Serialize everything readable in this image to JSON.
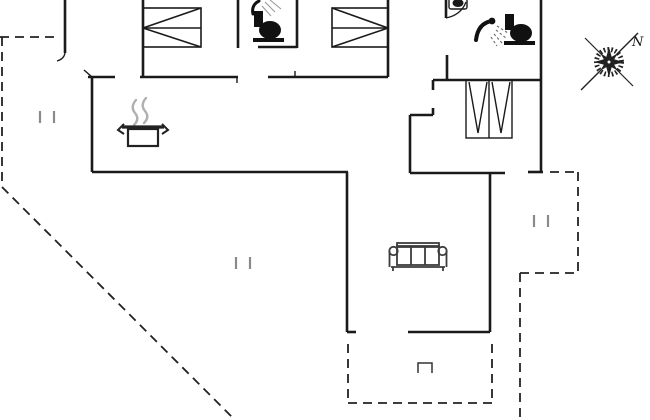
{
  "meta": {
    "type": "floor-plan",
    "compass_label": "N"
  },
  "colors": {
    "bg": "#ffffff",
    "wall": "#1a1a1a",
    "thin": "#1a1a1a",
    "dashed": "#222222",
    "window_mark": "#8a8a8a",
    "steam": "#b0b0b0",
    "sofa": "#3c3c3c",
    "icon": "#111111",
    "compass": "#222222"
  },
  "icons": [
    {
      "name": "double-bed-icon",
      "count": 2
    },
    {
      "name": "toilet-icon",
      "count": 2
    },
    {
      "name": "shower-icon",
      "count": 2
    },
    {
      "name": "sink-icon",
      "count": 1
    },
    {
      "name": "wardrobe-icon",
      "count": 1
    },
    {
      "name": "cooking-pot-icon",
      "count": 1
    },
    {
      "name": "sofa-icon",
      "count": 1
    },
    {
      "name": "terrace-step-icon",
      "count": 1
    },
    {
      "name": "compass-rose",
      "count": 1
    },
    {
      "name": "window-mark",
      "count": 3
    }
  ],
  "geometry": {
    "solid_walls": [
      [
        88,
        77,
        115,
        77
      ],
      [
        140,
        77,
        238,
        77
      ],
      [
        258,
        47,
        297,
        47
      ],
      [
        268,
        77,
        388,
        77
      ],
      [
        433,
        80,
        541,
        80
      ],
      [
        410,
        115,
        433,
        115
      ],
      [
        92,
        172,
        348,
        172
      ],
      [
        410,
        173,
        505,
        173
      ],
      [
        528,
        172,
        543,
        172
      ],
      [
        408,
        332,
        490,
        332
      ],
      [
        347,
        332,
        356,
        332
      ],
      [
        65,
        0,
        65,
        53
      ],
      [
        92,
        77,
        92,
        172
      ],
      [
        143,
        0,
        143,
        77
      ],
      [
        238,
        0,
        238,
        48
      ],
      [
        297,
        0,
        297,
        48
      ],
      [
        388,
        0,
        388,
        77
      ],
      [
        446,
        0,
        446,
        18
      ],
      [
        447,
        55,
        447,
        80
      ],
      [
        410,
        115,
        410,
        173
      ],
      [
        347,
        172,
        347,
        332
      ],
      [
        490,
        173,
        490,
        332
      ],
      [
        541,
        0,
        541,
        172
      ],
      [
        433,
        80,
        433,
        90
      ],
      [
        433,
        108,
        433,
        115
      ]
    ],
    "thin_lines": [
      [
        237,
        77,
        237,
        83
      ],
      [
        295,
        71,
        295,
        77
      ],
      [
        84,
        70,
        92,
        77
      ]
    ],
    "arc_paths": [
      "M446,18 Q461,15 466,2",
      "M65,53 Q64,59 57,61"
    ],
    "dashed_lines": [
      [
        0,
        37,
        57,
        37
      ],
      [
        2,
        37,
        2,
        187
      ],
      [
        2,
        187,
        235,
        420
      ],
      [
        550,
        172,
        578,
        172
      ],
      [
        578,
        172,
        578,
        273
      ],
      [
        520,
        273,
        578,
        273
      ],
      [
        520,
        273,
        520,
        420
      ],
      [
        348,
        344,
        348,
        402
      ],
      [
        348,
        403,
        492,
        403
      ],
      [
        492,
        344,
        492,
        403
      ]
    ],
    "window_marks": [
      [
        40,
        111,
        40,
        123
      ],
      [
        54,
        111,
        54,
        123
      ],
      [
        236,
        257,
        236,
        269
      ],
      [
        250,
        257,
        250,
        269
      ],
      [
        534,
        215,
        534,
        227
      ],
      [
        548,
        215,
        548,
        227
      ]
    ],
    "dash_pattern": "9,6"
  }
}
